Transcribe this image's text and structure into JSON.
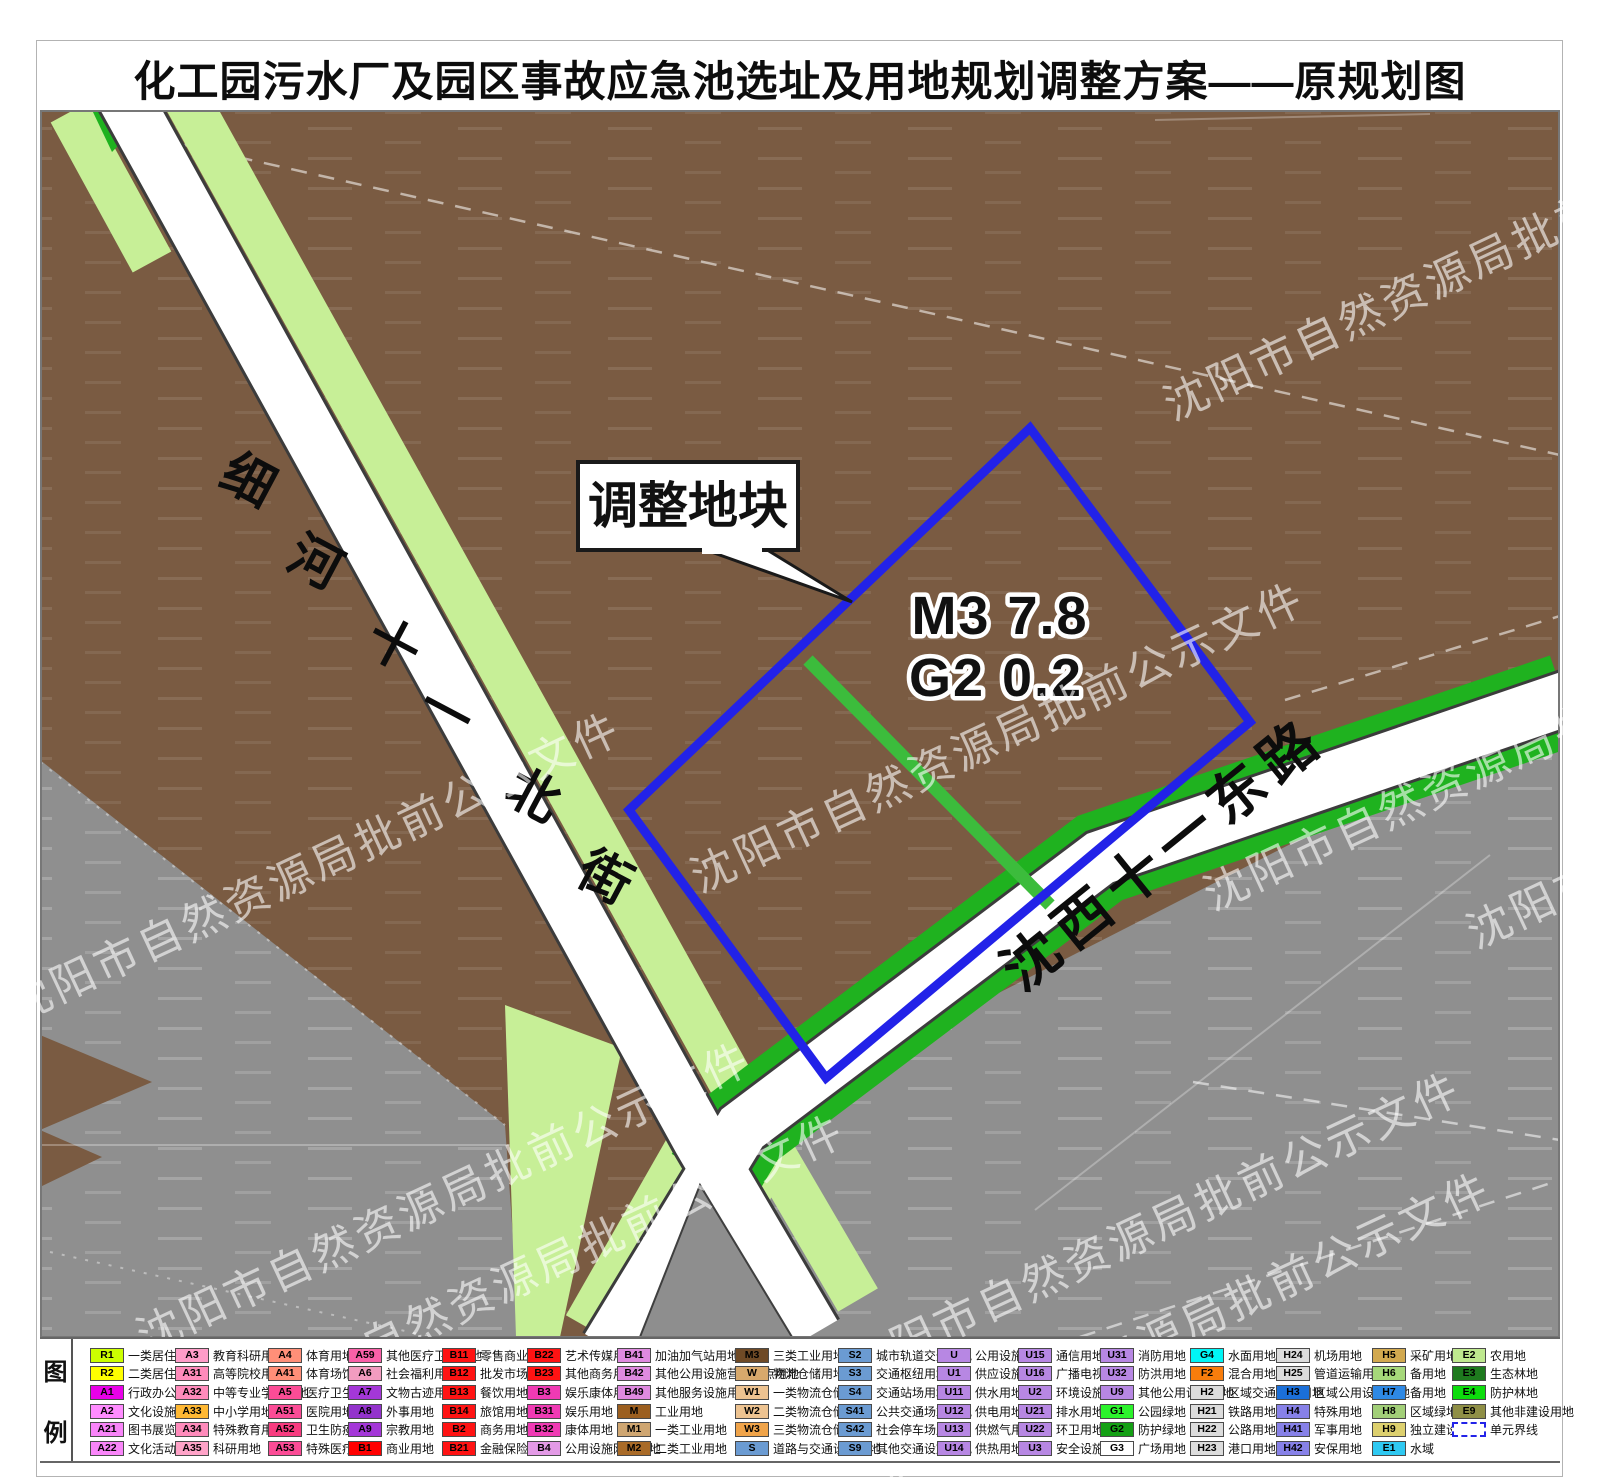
{
  "title": "化工园污水厂及园区事故应急池选址及用地规划调整方案——原规划图",
  "map": {
    "callout_label": "调整地块",
    "plot_line1": "M3  7.8",
    "plot_line2": "G2  0.2",
    "road_north_street": "细河十一北街",
    "road_east_road": "沈西十一东路",
    "watermark_text": "沈阳市自然资源局批前公示文件",
    "colors": {
      "brown": "#7a5b42",
      "lightgreen": "#c7ef97",
      "darkgreen": "#1fb21f",
      "blue": "#2222e8",
      "gray": "#8f8f8f",
      "strip": "#3cbc3c"
    }
  },
  "legend": {
    "label_top": "图",
    "label_bottom": "例",
    "columns": [
      [
        {
          "code": "R1",
          "color": "#ccff00",
          "label": "一类居住用地"
        },
        {
          "code": "R2",
          "color": "#ffff00",
          "label": "二类居住用地"
        },
        {
          "code": "A1",
          "color": "#e800e8",
          "label": "行政办公用地"
        },
        {
          "code": "A2",
          "color": "#ff8cff",
          "label": "文化设施用地"
        },
        {
          "code": "A21",
          "color": "#f985f9",
          "label": "图书展览用地"
        },
        {
          "code": "A22",
          "color": "#f985f9",
          "label": "文化活动用地"
        }
      ],
      [
        {
          "code": "A3",
          "color": "#ff9cc8",
          "label": "教育科研用地"
        },
        {
          "code": "A31",
          "color": "#ff8bbb",
          "label": "高等院校用地"
        },
        {
          "code": "A32",
          "color": "#ff8bbb",
          "label": "中等专业学校用地"
        },
        {
          "code": "A33",
          "color": "#ffb833",
          "label": "中小学用地"
        },
        {
          "code": "A34",
          "color": "#ff8bbb",
          "label": "特殊教育用地"
        },
        {
          "code": "A35",
          "color": "#ffa3c8",
          "label": "科研用地"
        }
      ],
      [
        {
          "code": "A4",
          "color": "#ff8f78",
          "label": "体育用地"
        },
        {
          "code": "A41",
          "color": "#ff8f78",
          "label": "体育场馆用地"
        },
        {
          "code": "A5",
          "color": "#fb4c96",
          "label": "医疗卫生用地"
        },
        {
          "code": "A51",
          "color": "#fb4c96",
          "label": "医院用地"
        },
        {
          "code": "A52",
          "color": "#f83c80",
          "label": "卫生防疫用地"
        },
        {
          "code": "A53",
          "color": "#fb4c96",
          "label": "特殊医疗用地"
        }
      ],
      [
        {
          "code": "A59",
          "color": "#f960a8",
          "label": "其他医疗卫生用地"
        },
        {
          "code": "A6",
          "color": "#f29cc0",
          "label": "社会福利用地"
        },
        {
          "code": "A7",
          "color": "#a437d8",
          "label": "文物古迹用地"
        },
        {
          "code": "A8",
          "color": "#9333cc",
          "label": "外事用地"
        },
        {
          "code": "A9",
          "color": "#a437d8",
          "label": "宗教用地"
        },
        {
          "code": "B1",
          "color": "#ff0000",
          "label": "商业用地"
        }
      ],
      [
        {
          "code": "B11",
          "color": "#ff1313",
          "label": "零售商业用地"
        },
        {
          "code": "B12",
          "color": "#ff1313",
          "label": "批发市场用地"
        },
        {
          "code": "B13",
          "color": "#ff1313",
          "label": "餐饮用地"
        },
        {
          "code": "B14",
          "color": "#ff1313",
          "label": "旅馆用地"
        },
        {
          "code": "B2",
          "color": "#ff1313",
          "label": "商务用地"
        },
        {
          "code": "B21",
          "color": "#ff1313",
          "label": "金融保险用地"
        }
      ],
      [
        {
          "code": "B22",
          "color": "#ff1313",
          "label": "艺术传媒用地"
        },
        {
          "code": "B23",
          "color": "#ff1313",
          "label": "其他商务用地"
        },
        {
          "code": "B3",
          "color": "#f03ab4",
          "label": "娱乐康体用地"
        },
        {
          "code": "B31",
          "color": "#f03ab4",
          "label": "娱乐用地"
        },
        {
          "code": "B32",
          "color": "#f03ab4",
          "label": "康体用地"
        },
        {
          "code": "B4",
          "color": "#e39ae6",
          "label": "公用设施网点用地"
        }
      ],
      [
        {
          "code": "B41",
          "color": "#df8ae0",
          "label": "加油加气站用地"
        },
        {
          "code": "B42",
          "color": "#df8ae0",
          "label": "其他公用设施营业网点用地"
        },
        {
          "code": "B49",
          "color": "#df8ae0",
          "label": "其他服务设施用地"
        },
        {
          "code": "M",
          "color": "#9c5f1f",
          "label": "工业用地"
        },
        {
          "code": "M1",
          "color": "#cfa671",
          "label": "一类工业用地"
        },
        {
          "code": "M2",
          "color": "#a96b28",
          "label": "二类工业用地"
        }
      ],
      [
        {
          "code": "M3",
          "color": "#6f4a26",
          "label": "三类工业用地"
        },
        {
          "code": "W",
          "color": "#d8a96c",
          "label": "物流仓储用地"
        },
        {
          "code": "W1",
          "color": "#edc391",
          "label": "一类物流仓储用地"
        },
        {
          "code": "W2",
          "color": "#edc391",
          "label": "二类物流仓储用地"
        },
        {
          "code": "W3",
          "color": "#f0a44a",
          "label": "三类物流仓储用地"
        },
        {
          "code": "S",
          "color": "#6b9bd2",
          "label": "道路与交通设施用地"
        }
      ],
      [
        {
          "code": "S2",
          "color": "#6b9bd2",
          "label": "城市轨道交通用地"
        },
        {
          "code": "S3",
          "color": "#6b9bd2",
          "label": "交通枢纽用地"
        },
        {
          "code": "S4",
          "color": "#6b9bd2",
          "label": "交通站场用地"
        },
        {
          "code": "S41",
          "color": "#6b9bd2",
          "label": "公共交通场站用地"
        },
        {
          "code": "S42",
          "color": "#6b9bd2",
          "label": "社会停车场用地"
        },
        {
          "code": "S9",
          "color": "#6b9bd2",
          "label": "其他交通设施用地"
        }
      ],
      [
        {
          "code": "U",
          "color": "#b787e3",
          "label": "公用设施用地"
        },
        {
          "code": "U1",
          "color": "#b787e3",
          "label": "供应设施用地"
        },
        {
          "code": "U11",
          "color": "#b787e3",
          "label": "供水用地"
        },
        {
          "code": "U12",
          "color": "#b787e3",
          "label": "供电用地"
        },
        {
          "code": "U13",
          "color": "#b787e3",
          "label": "供燃气用地"
        },
        {
          "code": "U14",
          "color": "#b787e3",
          "label": "供热用地"
        }
      ],
      [
        {
          "code": "U15",
          "color": "#b787e3",
          "label": "通信用地"
        },
        {
          "code": "U16",
          "color": "#b787e3",
          "label": "广播电视用地"
        },
        {
          "code": "U2",
          "color": "#b787e3",
          "label": "环境设施用地"
        },
        {
          "code": "U21",
          "color": "#b787e3",
          "label": "排水用地"
        },
        {
          "code": "U22",
          "color": "#b787e3",
          "label": "环卫用地"
        },
        {
          "code": "U3",
          "color": "#b787e3",
          "label": "安全设施用地"
        }
      ],
      [
        {
          "code": "U31",
          "color": "#b787e3",
          "label": "消防用地"
        },
        {
          "code": "U32",
          "color": "#b787e3",
          "label": "防洪用地"
        },
        {
          "code": "U9",
          "color": "#b787e3",
          "label": "其他公用设施用地"
        },
        {
          "code": "G1",
          "color": "#2cf32c",
          "label": "公园绿地"
        },
        {
          "code": "G2",
          "color": "#14a014",
          "label": "防护绿地"
        },
        {
          "code": "G3",
          "color": "#ffffff",
          "label": "广场用地"
        }
      ],
      [
        {
          "code": "G4",
          "color": "#00f5f5",
          "label": "水面用地"
        },
        {
          "code": "F2",
          "color": "#f87d0c",
          "label": "混合用地"
        },
        {
          "code": "H2",
          "color": "#dcdcdc",
          "label": "区域交通设施用地"
        },
        {
          "code": "H21",
          "color": "#dcdcdc",
          "label": "铁路用地"
        },
        {
          "code": "H22",
          "color": "#dcdcdc",
          "label": "公路用地"
        },
        {
          "code": "H23",
          "color": "#dcdcdc",
          "label": "港口用地"
        }
      ],
      [
        {
          "code": "H24",
          "color": "#dcdcdc",
          "label": "机场用地"
        },
        {
          "code": "H25",
          "color": "#dcdcdc",
          "label": "管道运输用地"
        },
        {
          "code": "H3",
          "color": "#1b6fd8",
          "label": "区域公用设施用地"
        },
        {
          "code": "H4",
          "color": "#8781e8",
          "label": "特殊用地"
        },
        {
          "code": "H41",
          "color": "#8781e8",
          "label": "军事用地"
        },
        {
          "code": "H42",
          "color": "#8781e8",
          "label": "安保用地"
        }
      ],
      [
        {
          "code": "H5",
          "color": "#d2a94f",
          "label": "采矿用地"
        },
        {
          "code": "H6",
          "color": "#a6d87a",
          "label": "备用地"
        },
        {
          "code": "H7",
          "color": "#2e89e5",
          "label": "备用地"
        },
        {
          "code": "H8",
          "color": "#a2cf78",
          "label": "区域绿地"
        },
        {
          "code": "H9",
          "color": "#ddd06e",
          "label": "独立建设用地"
        },
        {
          "code": "E1",
          "color": "#2fc9f2",
          "label": "水域"
        }
      ],
      [
        {
          "code": "E2",
          "color": "#bfe98f",
          "label": "农用地"
        },
        {
          "code": "E3",
          "color": "#1e7a1e",
          "label": "生态林地"
        },
        {
          "code": "E4",
          "color": "#0ddd0d",
          "label": "防护林地"
        },
        {
          "code": "E9",
          "color": "#8f8f46",
          "label": "其他非建设用地"
        },
        {
          "code": "",
          "color": "#ffffff",
          "label": "单元界线",
          "dashed": true
        }
      ]
    ]
  }
}
